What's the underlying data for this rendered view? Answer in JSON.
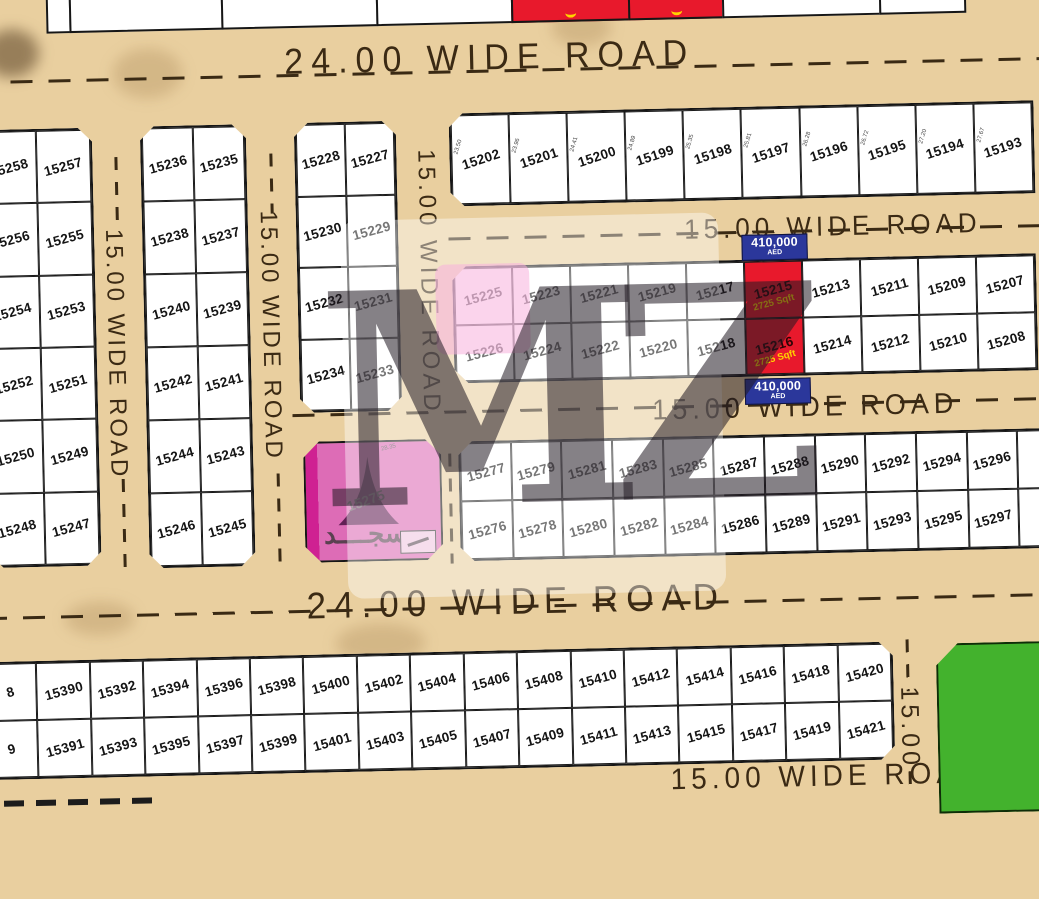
{
  "title": "Land plot map",
  "watermark": {
    "text": "MZ"
  },
  "roads": {
    "top_label": "24.00 WIDE ROAD",
    "upper_mid_label": "15.00 WIDE ROAD",
    "lower_mid_label": "15.00 WIDE ROAD",
    "bottom_label": "24.00 WIDE ROAD",
    "bottom_strip_label": "15.00 WIDE ROAD",
    "left_vertical_label": "15.00 WIDE ROAD",
    "center_left_vertical_label": "15.00 WIDE ROAD",
    "center_vertical_label": "15.00 WIDE ROAD",
    "right_vertical_label": "15.00"
  },
  "offer": {
    "price": "410,000",
    "currency": "AED",
    "area": "2725 Sqft",
    "highlight_plots": [
      "15215",
      "15216"
    ],
    "pink_plot": "15226"
  },
  "mosque": {
    "number": "15275",
    "name_ar": "مسجــــد",
    "dimension": "28.35"
  },
  "blocks": {
    "west": {
      "rows": [
        [
          "15258",
          "15257"
        ],
        [
          "15256",
          "15255"
        ],
        [
          "15254",
          "15253"
        ],
        [
          "15252",
          "15251"
        ],
        [
          "15250",
          "15249"
        ],
        [
          "15248",
          "15247"
        ]
      ]
    },
    "west_mid": {
      "rows": [
        [
          "15236",
          "15235"
        ],
        [
          "15238",
          "15237"
        ],
        [
          "15240",
          "15239"
        ],
        [
          "15242",
          "15241"
        ],
        [
          "15244",
          "15243"
        ],
        [
          "15246",
          "15245"
        ]
      ]
    },
    "center": {
      "rows": [
        [
          "15228",
          "15227"
        ],
        [
          "15230",
          "15229"
        ],
        [
          "15232",
          "15231"
        ],
        [
          "15234",
          "15233"
        ]
      ]
    },
    "north_strip": {
      "cells": [
        {
          "no": "15202",
          "dim": "23.50"
        },
        {
          "no": "15201",
          "dim": "23.96"
        },
        {
          "no": "15200",
          "dim": "24.41"
        },
        {
          "no": "15199",
          "dim": "24.89"
        },
        {
          "no": "15198",
          "dim": "25.35"
        },
        {
          "no": "15197",
          "dim": "25.81"
        },
        {
          "no": "15196",
          "dim": "26.28"
        },
        {
          "no": "15195",
          "dim": "26.72"
        },
        {
          "no": "15194",
          "dim": "27.20"
        },
        {
          "no": "15193",
          "dim": "27.67"
        }
      ]
    },
    "east_upper": {
      "row1": [
        "15225",
        "15223",
        "15221",
        "15219",
        "15217",
        "15215",
        "15213",
        "15211",
        "15209",
        "15207"
      ],
      "row2": [
        "15226",
        "15224",
        "15222",
        "15220",
        "15218",
        "15216",
        "15214",
        "15212",
        "15210",
        "15208"
      ]
    },
    "east_lower": {
      "row1": [
        "15277",
        "15279",
        "15281",
        "15283",
        "15285",
        "15287",
        "15288",
        "15290",
        "15292",
        "15294",
        "15296",
        ""
      ],
      "row2": [
        "15276",
        "15278",
        "15280",
        "15282",
        "15284",
        "15286",
        "15289",
        "15291",
        "15293",
        "15295",
        "15297",
        ""
      ]
    },
    "south": {
      "row1": [
        "8",
        "15390",
        "15392",
        "15394",
        "15396",
        "15398",
        "15400",
        "15402",
        "15404",
        "15406",
        "15408",
        "15410",
        "15412",
        "15414",
        "15416",
        "15418",
        "15420"
      ],
      "row2": [
        "9",
        "15391",
        "15393",
        "15395",
        "15397",
        "15399",
        "15401",
        "15403",
        "15405",
        "15407",
        "15409",
        "15411",
        "15413",
        "15415",
        "15417",
        "15419",
        "15421"
      ]
    }
  },
  "colors": {
    "road_tan": "#e9cf9f",
    "plot_white": "#ffffff",
    "highlight_red": "#e8192c",
    "badge_blue": "#2b379b",
    "price_yellow": "#ffd400",
    "mosque_pink": "#cf2192",
    "garden_green": "#43b22d",
    "line_dark": "#3a2a14"
  }
}
